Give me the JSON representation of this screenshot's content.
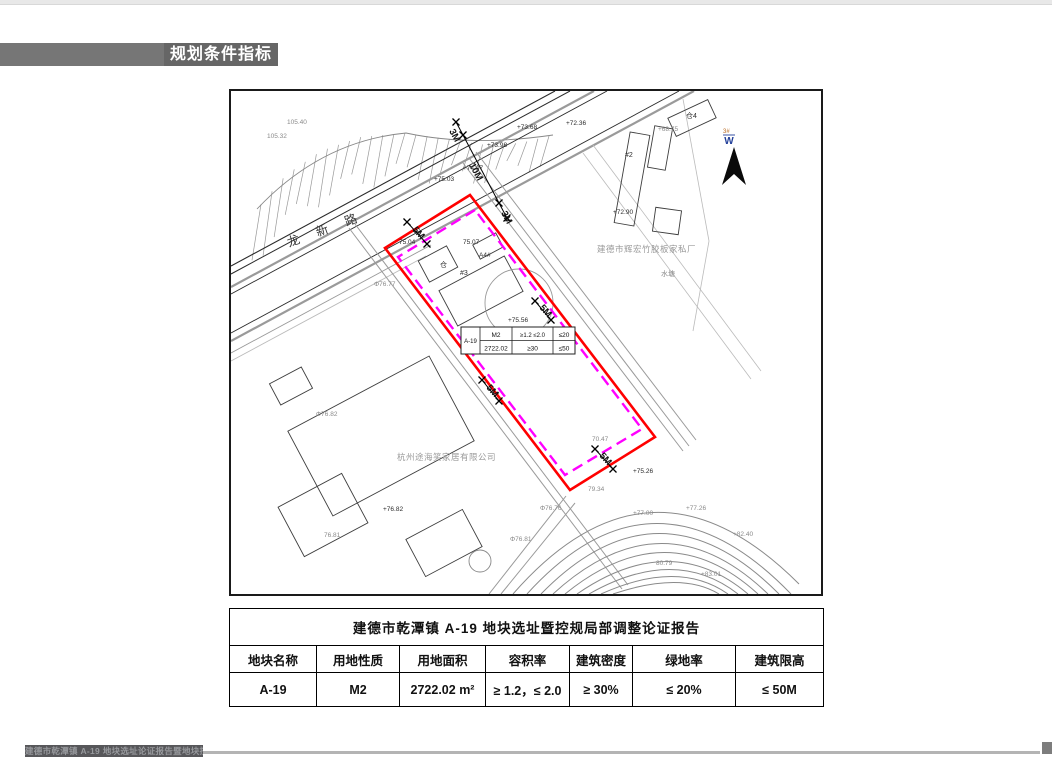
{
  "header": {
    "title": "规划条件指标"
  },
  "footer": {
    "text": "建德市乾潭镇 A-19 地块选址论证报告暨地块控规"
  },
  "colors": {
    "site_boundary_red": "#ff0000",
    "setback_magenta": "#ff00ff",
    "header_bar_gray": "#767676",
    "header_bar_dark": "#666666",
    "footer_bar_gray": "#57575a",
    "north_label_blue": "#23409a"
  },
  "map": {
    "road_name": "龙新路",
    "north_arrow": {
      "label": "W",
      "sublabel": "3#"
    },
    "company_left": "杭州途海笑家居有限公司",
    "company_right": "建德市辉宏竹胶板家私厂",
    "inline_table": {
      "plot_name": "A-19",
      "land_use": "M2",
      "far": "≥1.2 ≤2.0",
      "green": "≤20",
      "area": "2722.02",
      "density": "≥30",
      "height": "≤50"
    },
    "dimensions": [
      {
        "text": "3M",
        "x": 218,
        "y": 40,
        "r": 62
      },
      {
        "text": "10M",
        "x": 238,
        "y": 74,
        "r": 62
      },
      {
        "text": "3M",
        "x": 270,
        "y": 122,
        "r": 62
      },
      {
        "text": "5M",
        "x": 181,
        "y": 139,
        "r": 48
      },
      {
        "text": "5M",
        "x": 308,
        "y": 217,
        "r": 48
      },
      {
        "text": "5M",
        "x": 255,
        "y": 297,
        "r": 48
      },
      {
        "text": "5M",
        "x": 368,
        "y": 365,
        "r": 48
      }
    ],
    "labels": [
      {
        "text": "105.40",
        "x": 56,
        "y": 33,
        "c": "#8a8a8a"
      },
      {
        "text": "105.32",
        "x": 36,
        "y": 47,
        "c": "#8a8a8a"
      },
      {
        "text": "+75.03",
        "x": 203,
        "y": 90
      },
      {
        "text": "+74.07",
        "x": 232,
        "y": 79
      },
      {
        "text": "+73.98",
        "x": 256,
        "y": 56
      },
      {
        "text": "+73.68",
        "x": 286,
        "y": 38
      },
      {
        "text": "+72.36",
        "x": 335,
        "y": 34
      },
      {
        "text": "+68.75",
        "x": 427,
        "y": 40,
        "c": "#8a8a8a"
      },
      {
        "text": "仓4",
        "x": 455,
        "y": 27,
        "s": 7
      },
      {
        "text": "#2",
        "x": 394,
        "y": 66,
        "s": 7
      },
      {
        "text": "+72.90",
        "x": 382,
        "y": 123
      },
      {
        "text": "75.04",
        "x": 168,
        "y": 153
      },
      {
        "text": "75.07",
        "x": 232,
        "y": 153
      },
      {
        "text": "仓",
        "x": 209,
        "y": 176,
        "s": 7
      },
      {
        "text": "A4#",
        "x": 248,
        "y": 166
      },
      {
        "text": "#3",
        "x": 229,
        "y": 184,
        "s": 7
      },
      {
        "text": "+75.56",
        "x": 277,
        "y": 231
      },
      {
        "text": "Φ76.77",
        "x": 143,
        "y": 195,
        "c": "#8a8a8a"
      },
      {
        "text": "水塘",
        "x": 430,
        "y": 185,
        "c": "#8a8a8a",
        "s": 7
      },
      {
        "text": "Φ76.82",
        "x": 85,
        "y": 325,
        "c": "#8a8a8a"
      },
      {
        "text": "+76.82",
        "x": 152,
        "y": 420
      },
      {
        "text": "76.81",
        "x": 93,
        "y": 446,
        "c": "#8a8a8a"
      },
      {
        "text": "Φ76.81",
        "x": 279,
        "y": 450,
        "c": "#8a8a8a"
      },
      {
        "text": "Φ76.76",
        "x": 309,
        "y": 419,
        "c": "#8a8a8a"
      },
      {
        "text": "70.47",
        "x": 361,
        "y": 350,
        "c": "#8a8a8a"
      },
      {
        "text": "79.34",
        "x": 357,
        "y": 400,
        "c": "#8a8a8a"
      },
      {
        "text": "+75.26",
        "x": 402,
        "y": 382
      },
      {
        "text": "+77.00",
        "x": 402,
        "y": 424,
        "c": "#8a8a8a"
      },
      {
        "text": "+77.26",
        "x": 455,
        "y": 419,
        "c": "#8a8a8a"
      },
      {
        "text": "80.79",
        "x": 425,
        "y": 474,
        "c": "#8a8a8a"
      },
      {
        "text": "+82.40",
        "x": 502,
        "y": 445,
        "c": "#8a8a8a"
      },
      {
        "text": "+83.01",
        "x": 470,
        "y": 485,
        "c": "#8a8a8a"
      }
    ]
  },
  "table": {
    "title": "建德市乾潭镇 A-19 地块选址暨控规局部调整论证报告",
    "headers": [
      "地块名称",
      "用地性质",
      "用地面积",
      "容积率",
      "建筑密度",
      "绿地率",
      "建筑限高"
    ],
    "row": [
      "A-19",
      "M2",
      "2722.02 m²",
      "≥ 1.2，≤ 2.0",
      "≥ 30%",
      "≤ 20%",
      "≤ 50M"
    ]
  }
}
